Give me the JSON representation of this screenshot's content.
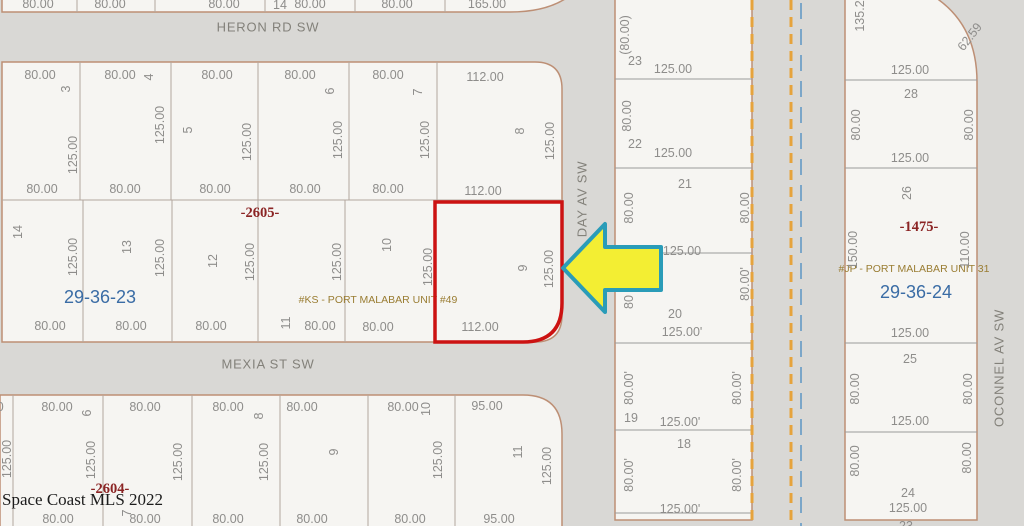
{
  "colors": {
    "street-gray": "#d9d8d5",
    "lot-fill": "#f6f5f2",
    "line-tan": "#bd8f75",
    "line-gray": "#9b9b9b",
    "line-inner": "#b3a79e",
    "text-gray": "#8e8d8b",
    "section-blue": "#3a6ca5",
    "plat-red": "#8b2424",
    "unit-olive": "#9a7d33",
    "highlight-red": "#cc1212",
    "arrow-fill": "#f3ee33",
    "arrow-stroke": "#2a9cb8",
    "dash-orange": "#e6a33c",
    "dash-blue": "#7ba6c8"
  },
  "map": {
    "watermark": {
      "text": "Space Coast MLS 2022"
    },
    "highlighted_lot": "9",
    "label_groups": [
      {
        "name": "street-label",
        "cls": "street",
        "items": [
          {
            "t": "HERON RD SW",
            "x": 268,
            "y": 27
          },
          {
            "t": "MEXIA ST SW",
            "x": 268,
            "y": 364
          },
          {
            "t": "DAY AV SW",
            "x": 582,
            "y": 199,
            "r": -90
          },
          {
            "t": "OCONNEL AV SW",
            "x": 999,
            "y": 368,
            "r": -90
          }
        ]
      },
      {
        "name": "section-label",
        "cls": "section",
        "items": [
          {
            "t": "29-36-23",
            "x": 100,
            "y": 297
          },
          {
            "t": "29-36-24",
            "x": 916,
            "y": 292
          }
        ]
      },
      {
        "name": "plat-label",
        "cls": "plat",
        "items": [
          {
            "t": "-2605-",
            "x": 260,
            "y": 213
          },
          {
            "t": "-2604-",
            "x": 110,
            "y": 489
          },
          {
            "t": "-1475-",
            "x": 919,
            "y": 227
          }
        ]
      },
      {
        "name": "unit-label",
        "cls": "unit",
        "items": [
          {
            "t": "#KS - PORT MALABAR UNIT #49",
            "x": 378,
            "y": 300
          },
          {
            "t": "#JP - PORT MALABAR UNIT 31",
            "x": 914,
            "y": 269
          }
        ]
      },
      {
        "name": "lot-number",
        "cls": "num",
        "items": [
          {
            "t": "14",
            "x": 280,
            "y": 5
          },
          {
            "t": "3",
            "x": 66,
            "y": 89,
            "r": -90
          },
          {
            "t": "4",
            "x": 149,
            "y": 77,
            "r": -90
          },
          {
            "t": "5",
            "x": 188,
            "y": 130,
            "r": -90
          },
          {
            "t": "6",
            "x": 330,
            "y": 91,
            "r": -90
          },
          {
            "t": "7",
            "x": 418,
            "y": 92,
            "r": -90
          },
          {
            "t": "8",
            "x": 520,
            "y": 131,
            "r": -90
          },
          {
            "t": "14",
            "x": 18,
            "y": 232,
            "r": -90
          },
          {
            "t": "13",
            "x": 127,
            "y": 247,
            "r": -90
          },
          {
            "t": "12",
            "x": 213,
            "y": 261,
            "r": -90
          },
          {
            "t": "11",
            "x": 286,
            "y": 323,
            "r": -90
          },
          {
            "t": "10",
            "x": 387,
            "y": 245,
            "r": -90
          },
          {
            "t": "9",
            "x": 523,
            "y": 268,
            "r": -90
          },
          {
            "t": "6",
            "x": 87,
            "y": 413,
            "r": -90
          },
          {
            "t": "7",
            "x": 127,
            "y": 513,
            "r": -90
          },
          {
            "t": "8",
            "x": 259,
            "y": 416,
            "r": -90
          },
          {
            "t": "9",
            "x": 334,
            "y": 452,
            "r": -90
          },
          {
            "t": "10",
            "x": 426,
            "y": 409,
            "r": -90
          },
          {
            "t": "11",
            "x": 518,
            "y": 452,
            "r": -90
          },
          {
            "t": "23",
            "x": 635,
            "y": 61
          },
          {
            "t": "22",
            "x": 635,
            "y": 144
          },
          {
            "t": "21",
            "x": 685,
            "y": 184
          },
          {
            "t": "20",
            "x": 675,
            "y": 314
          },
          {
            "t": "19",
            "x": 631,
            "y": 418
          },
          {
            "t": "18",
            "x": 684,
            "y": 444
          },
          {
            "t": "28",
            "x": 911,
            "y": 94
          },
          {
            "t": "26",
            "x": 907,
            "y": 193,
            "r": -90
          },
          {
            "t": "25",
            "x": 910,
            "y": 359
          },
          {
            "t": "24",
            "x": 908,
            "y": 493
          },
          {
            "t": "23",
            "x": 906,
            "y": 526
          }
        ]
      },
      {
        "name": "dim-label",
        "cls": "dim",
        "items": [
          {
            "t": "80.00",
            "x": 38,
            "y": 4
          },
          {
            "t": "80.00",
            "x": 110,
            "y": 4
          },
          {
            "t": "80.00",
            "x": 224,
            "y": 4
          },
          {
            "t": "80.00",
            "x": 310,
            "y": 4
          },
          {
            "t": "80.00",
            "x": 397,
            "y": 4
          },
          {
            "t": "165.00",
            "x": 487,
            "y": 4
          },
          {
            "t": "80.00",
            "x": 40,
            "y": 75
          },
          {
            "t": "80.00",
            "x": 120,
            "y": 75
          },
          {
            "t": "80.00",
            "x": 217,
            "y": 75
          },
          {
            "t": "80.00",
            "x": 300,
            "y": 75
          },
          {
            "t": "80.00",
            "x": 388,
            "y": 75
          },
          {
            "t": "112.00",
            "x": 485,
            "y": 77
          },
          {
            "t": "125.00",
            "x": 73,
            "y": 155,
            "r": -90
          },
          {
            "t": "125.00",
            "x": 160,
            "y": 125,
            "r": -90
          },
          {
            "t": "125.00",
            "x": 247,
            "y": 142,
            "r": -90
          },
          {
            "t": "125.00",
            "x": 338,
            "y": 140,
            "r": -90
          },
          {
            "t": "125.00",
            "x": 425,
            "y": 140,
            "r": -90
          },
          {
            "t": "125.00",
            "x": 550,
            "y": 141,
            "r": -90
          },
          {
            "t": "80.00",
            "x": 42,
            "y": 189
          },
          {
            "t": "80.00",
            "x": 125,
            "y": 189
          },
          {
            "t": "80.00",
            "x": 215,
            "y": 189
          },
          {
            "t": "80.00",
            "x": 305,
            "y": 189
          },
          {
            "t": "80.00",
            "x": 388,
            "y": 189
          },
          {
            "t": "112.00",
            "x": 483,
            "y": 191
          },
          {
            "t": "125.00",
            "x": 73,
            "y": 257,
            "r": -90
          },
          {
            "t": "125.00",
            "x": 160,
            "y": 258,
            "r": -90
          },
          {
            "t": "125.00",
            "x": 250,
            "y": 262,
            "r": -90
          },
          {
            "t": "125.00",
            "x": 337,
            "y": 262,
            "r": -90
          },
          {
            "t": "125.00",
            "x": 428,
            "y": 267,
            "r": -90
          },
          {
            "t": "125.00",
            "x": 549,
            "y": 269,
            "r": -90
          },
          {
            "t": "80.00",
            "x": 50,
            "y": 326
          },
          {
            "t": "80.00",
            "x": 131,
            "y": 326
          },
          {
            "t": "80.00",
            "x": 211,
            "y": 326
          },
          {
            "t": "80.00",
            "x": 320,
            "y": 326
          },
          {
            "t": "80.00",
            "x": 378,
            "y": 327
          },
          {
            "t": "112.00",
            "x": 480,
            "y": 327
          },
          {
            "t": "80.00",
            "x": -12,
            "y": 407
          },
          {
            "t": "80.00",
            "x": 57,
            "y": 407
          },
          {
            "t": "80.00",
            "x": 145,
            "y": 407
          },
          {
            "t": "80.00",
            "x": 228,
            "y": 407
          },
          {
            "t": "80.00",
            "x": 302,
            "y": 407
          },
          {
            "t": "80.00",
            "x": 403,
            "y": 407
          },
          {
            "t": "95.00",
            "x": 487,
            "y": 406
          },
          {
            "t": "125.00",
            "x": 7,
            "y": 459,
            "r": -90
          },
          {
            "t": "125.00",
            "x": 91,
            "y": 460,
            "r": -90
          },
          {
            "t": "125.00",
            "x": 178,
            "y": 462,
            "r": -90
          },
          {
            "t": "125.00",
            "x": 264,
            "y": 462,
            "r": -90
          },
          {
            "t": "125.00",
            "x": 438,
            "y": 460,
            "r": -90
          },
          {
            "t": "125.00",
            "x": 547,
            "y": 466,
            "r": -90
          },
          {
            "t": "80.00",
            "x": 58,
            "y": 519
          },
          {
            "t": "80.00",
            "x": 145,
            "y": 519
          },
          {
            "t": "80.00",
            "x": 228,
            "y": 519
          },
          {
            "t": "80.00",
            "x": 312,
            "y": 519
          },
          {
            "t": "80.00",
            "x": 410,
            "y": 519
          },
          {
            "t": "95.00",
            "x": 499,
            "y": 519
          },
          {
            "t": "(80.00)",
            "x": 625,
            "y": 35,
            "r": -90
          },
          {
            "t": "125.00",
            "x": 673,
            "y": 69
          },
          {
            "t": "80.00",
            "x": 627,
            "y": 116,
            "r": -90
          },
          {
            "t": "125.00",
            "x": 673,
            "y": 153
          },
          {
            "t": "80.00",
            "x": 629,
            "y": 208,
            "r": -90
          },
          {
            "t": "80.00",
            "x": 745,
            "y": 208,
            "r": -90
          },
          {
            "t": "125.00",
            "x": 682,
            "y": 251
          },
          {
            "t": "80",
            "x": 629,
            "y": 302,
            "r": -90
          },
          {
            "t": "80.00'",
            "x": 745,
            "y": 284,
            "r": -90
          },
          {
            "t": "125.00'",
            "x": 682,
            "y": 332
          },
          {
            "t": "80.00'",
            "x": 629,
            "y": 388,
            "r": -90
          },
          {
            "t": "80.00'",
            "x": 737,
            "y": 388,
            "r": -90
          },
          {
            "t": "125.00'",
            "x": 680,
            "y": 422
          },
          {
            "t": "80.00'",
            "x": 629,
            "y": 475,
            "r": -90
          },
          {
            "t": "80.00'",
            "x": 737,
            "y": 475,
            "r": -90
          },
          {
            "t": "125.00'",
            "x": 680,
            "y": 509
          },
          {
            "t": "135.2",
            "x": 860,
            "y": 16,
            "r": -90
          },
          {
            "t": "62.59",
            "x": 970,
            "y": 37,
            "r": -52
          },
          {
            "t": "125.00",
            "x": 910,
            "y": 70
          },
          {
            "t": "80.00",
            "x": 856,
            "y": 125,
            "r": -90
          },
          {
            "t": "80.00",
            "x": 969,
            "y": 125,
            "r": -90
          },
          {
            "t": "125.00",
            "x": 910,
            "y": 158
          },
          {
            "t": "150.00",
            "x": 853,
            "y": 250,
            "r": -90
          },
          {
            "t": "110.00",
            "x": 965,
            "y": 250,
            "r": -90
          },
          {
            "t": "125.00",
            "x": 910,
            "y": 333
          },
          {
            "t": "80.00",
            "x": 855,
            "y": 389,
            "r": -90
          },
          {
            "t": "80.00",
            "x": 968,
            "y": 389,
            "r": -90
          },
          {
            "t": "125.00",
            "x": 910,
            "y": 421
          },
          {
            "t": "80.00",
            "x": 855,
            "y": 461,
            "r": -90
          },
          {
            "t": "80.00",
            "x": 967,
            "y": 458,
            "r": -90
          },
          {
            "t": "125.00",
            "x": 908,
            "y": 508
          }
        ]
      }
    ]
  }
}
